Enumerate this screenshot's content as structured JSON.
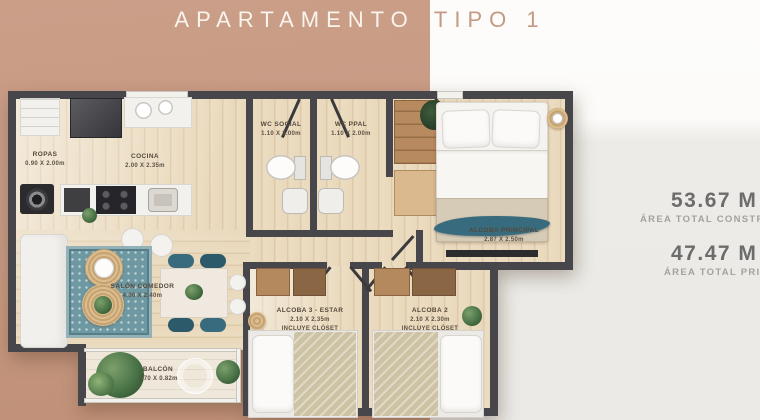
{
  "title": {
    "part1": "APARTAMENTO",
    "part2": "TIPO 1"
  },
  "area_panel": {
    "built_value": "53.67 M",
    "built_label": "ÁREA TOTAL CONSTR",
    "private_value": "47.47 M",
    "private_label": "ÁREA TOTAL PRIV"
  },
  "rooms": {
    "ropas": {
      "name": "ROPAS",
      "dims": "0.90 X 2.00m"
    },
    "cocina": {
      "name": "COCINA",
      "dims": "2.00 X 2.35m"
    },
    "wc_social": {
      "name": "WC SOCIAL",
      "dims": "1.10 X 2.00m"
    },
    "wc_ppal": {
      "name": "WC PPAL",
      "dims": "1.10 X 2.00m"
    },
    "alcoba_principal": {
      "name": "ALCOBA PRINCIPAL",
      "dims": "2.87 X 2.50m"
    },
    "salon_comedor": {
      "name": "SALÓN COMEDOR",
      "dims": "4.00 X 2.40m"
    },
    "alcoba_3": {
      "name": "ALCOBA 3 - ESTAR",
      "dims": "2.10 X 2.35m",
      "note": "INCLUYE CLÓSET"
    },
    "alcoba_2": {
      "name": "ALCOBA 2",
      "dims": "2.10 X 2.30m",
      "note": "INCLUYE CLÓSET"
    },
    "balcon": {
      "name": "BALCÓN",
      "dims": "2.70 X 0.82m"
    }
  },
  "palette": {
    "accent_tan": "#c69a83",
    "wall_gray": "#47464a",
    "wood_floor": "#e9d8ba",
    "teal_accent": "#386b7d",
    "panel_gray": "#ecebe7",
    "number_gray": "#6c6c6c",
    "caption_gray": "#a3a29d"
  }
}
